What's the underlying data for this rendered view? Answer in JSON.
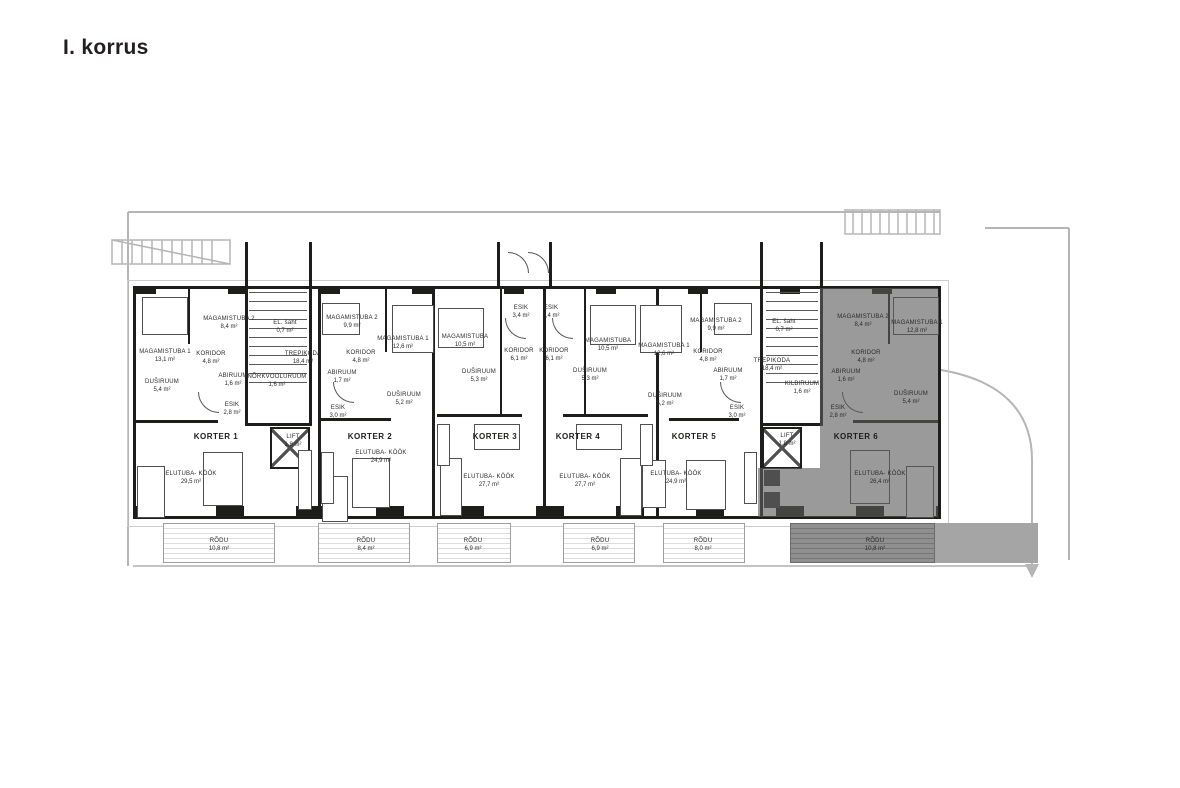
{
  "title": "I. korrus",
  "colors": {
    "wall": "#1d1d1b",
    "site_line": "#b5b5b5",
    "highlight_fill": "#8f8f8f",
    "paper": "#ffffff"
  },
  "units": {
    "korter1": {
      "label": "KORTER 1",
      "highlighted": false,
      "rooms": {
        "magamistuba1": {
          "name": "MAGAMISTUBA 1",
          "area": "13,1 m²"
        },
        "magamistuba2": {
          "name": "MAGAMISTUBA 2",
          "area": "8,4 m²"
        },
        "koridor": {
          "name": "KORIDOR",
          "area": "4,8 m²"
        },
        "abiruum": {
          "name": "ABIRUUM",
          "area": "1,6 m²"
        },
        "dusiruum": {
          "name": "DUŠIRUUM",
          "area": "5,4 m²"
        },
        "esik": {
          "name": "ESIK",
          "area": "2,8 m²"
        },
        "elutuba": {
          "name": "ELUTUBA- KÖÖK",
          "area": "29,5 m²"
        },
        "rodu": {
          "name": "RÕDU",
          "area": "10,8 m²"
        }
      }
    },
    "korter2": {
      "label": "KORTER 2",
      "highlighted": false,
      "rooms": {
        "magamistuba1": {
          "name": "MAGAMISTUBA 1",
          "area": "12,6 m²"
        },
        "magamistuba2": {
          "name": "MAGAMISTUBA 2",
          "area": "9,9 m²"
        },
        "koridor": {
          "name": "KORIDOR",
          "area": "4,8 m²"
        },
        "abiruum": {
          "name": "ABIRUUM",
          "area": "1,7 m²"
        },
        "dusiruum": {
          "name": "DUŠIRUUM",
          "area": "5,2 m²"
        },
        "esik": {
          "name": "ESIK",
          "area": "3,0 m²"
        },
        "elutuba": {
          "name": "ELUTUBA- KÖÖK",
          "area": "24,9 m²"
        },
        "rodu": {
          "name": "RÕDU",
          "area": "8,4 m²"
        }
      }
    },
    "korter3": {
      "label": "KORTER 3",
      "highlighted": false,
      "rooms": {
        "esik": {
          "name": "ESIK",
          "area": "3,4 m²"
        },
        "magamistuba": {
          "name": "MAGAMISTUBA",
          "area": "10,5 m²"
        },
        "koridor": {
          "name": "KORIDOR",
          "area": "6,1 m²"
        },
        "dusiruum": {
          "name": "DUŠIRUUM",
          "area": "5,3 m²"
        },
        "elutuba": {
          "name": "ELUTUBA- KÖÖK",
          "area": "27,7 m²"
        },
        "rodu": {
          "name": "RÕDU",
          "area": "6,9 m²"
        }
      }
    },
    "korter4": {
      "label": "KORTER 4",
      "highlighted": false,
      "rooms": {
        "esik": {
          "name": "ESIK",
          "area": "3,4 m²"
        },
        "magamistuba": {
          "name": "MAGAMISTUBA",
          "area": "10,5 m²"
        },
        "koridor": {
          "name": "KORIDOR",
          "area": "6,1 m²"
        },
        "dusiruum": {
          "name": "DUŠIRUUM",
          "area": "5,3 m²"
        },
        "elutuba": {
          "name": "ELUTUBA- KÖÖK",
          "area": "27,7 m²"
        },
        "rodu": {
          "name": "RÕDU",
          "area": "6,9 m²"
        }
      }
    },
    "korter5": {
      "label": "KORTER 5",
      "highlighted": false,
      "rooms": {
        "magamistuba1": {
          "name": "MAGAMISTUBA 1",
          "area": "12,6 m²"
        },
        "magamistuba2": {
          "name": "MAGAMISTUBA 2",
          "area": "9,9 m²"
        },
        "koridor": {
          "name": "KORIDOR",
          "area": "4,8 m²"
        },
        "abiruum": {
          "name": "ABIRUUM",
          "area": "1,7 m²"
        },
        "dusiruum": {
          "name": "DUŠIRUUM",
          "area": "5,2 m²"
        },
        "esik": {
          "name": "ESIK",
          "area": "3,0 m²"
        },
        "elutuba": {
          "name": "ELUTUBA- KÖÖK",
          "area": "24,9 m²"
        },
        "rodu": {
          "name": "RÕDU",
          "area": "8,0 m²"
        }
      }
    },
    "korter6": {
      "label": "KORTER 6",
      "highlighted": true,
      "rooms": {
        "magamistuba1": {
          "name": "MAGAMISTUBA 1",
          "area": "12,8 m²"
        },
        "magamistuba2": {
          "name": "MAGAMISTUBA 2",
          "area": "8,4 m²"
        },
        "koridor": {
          "name": "KORIDOR",
          "area": "4,8 m²"
        },
        "abiruum": {
          "name": "ABIRUUM",
          "area": "1,6 m²"
        },
        "dusiruum": {
          "name": "DUŠIRUUM",
          "area": "5,4 m²"
        },
        "esik": {
          "name": "ESIK",
          "area": "2,8 m²"
        },
        "elutuba": {
          "name": "ELUTUBA- KÖÖK",
          "area": "26,4 m²"
        },
        "rodu": {
          "name": "RÕDU",
          "area": "10,8 m²"
        }
      }
    }
  },
  "stairwells": {
    "west": {
      "elsaht": {
        "name": "EL. šaht",
        "area": "0,7 m²"
      },
      "trepikoda": {
        "name": "TREPIKODA",
        "area": "18,4 m²"
      },
      "norkvooluruum": {
        "name": "NÕRKVOOLURUUM",
        "area": "1,6 m²"
      },
      "lift": {
        "name": "LIFT",
        "area": "1,8 m²"
      }
    },
    "east": {
      "elsaht": {
        "name": "EL. šaht",
        "area": "0,7 m²"
      },
      "trepikoda": {
        "name": "TREPIKODA",
        "area": "18,4 m²"
      },
      "kilbiruum": {
        "name": "KILBIRUUM",
        "area": "1,6 m²"
      },
      "lift": {
        "name": "LIFT",
        "area": "1,8 m²"
      }
    }
  }
}
